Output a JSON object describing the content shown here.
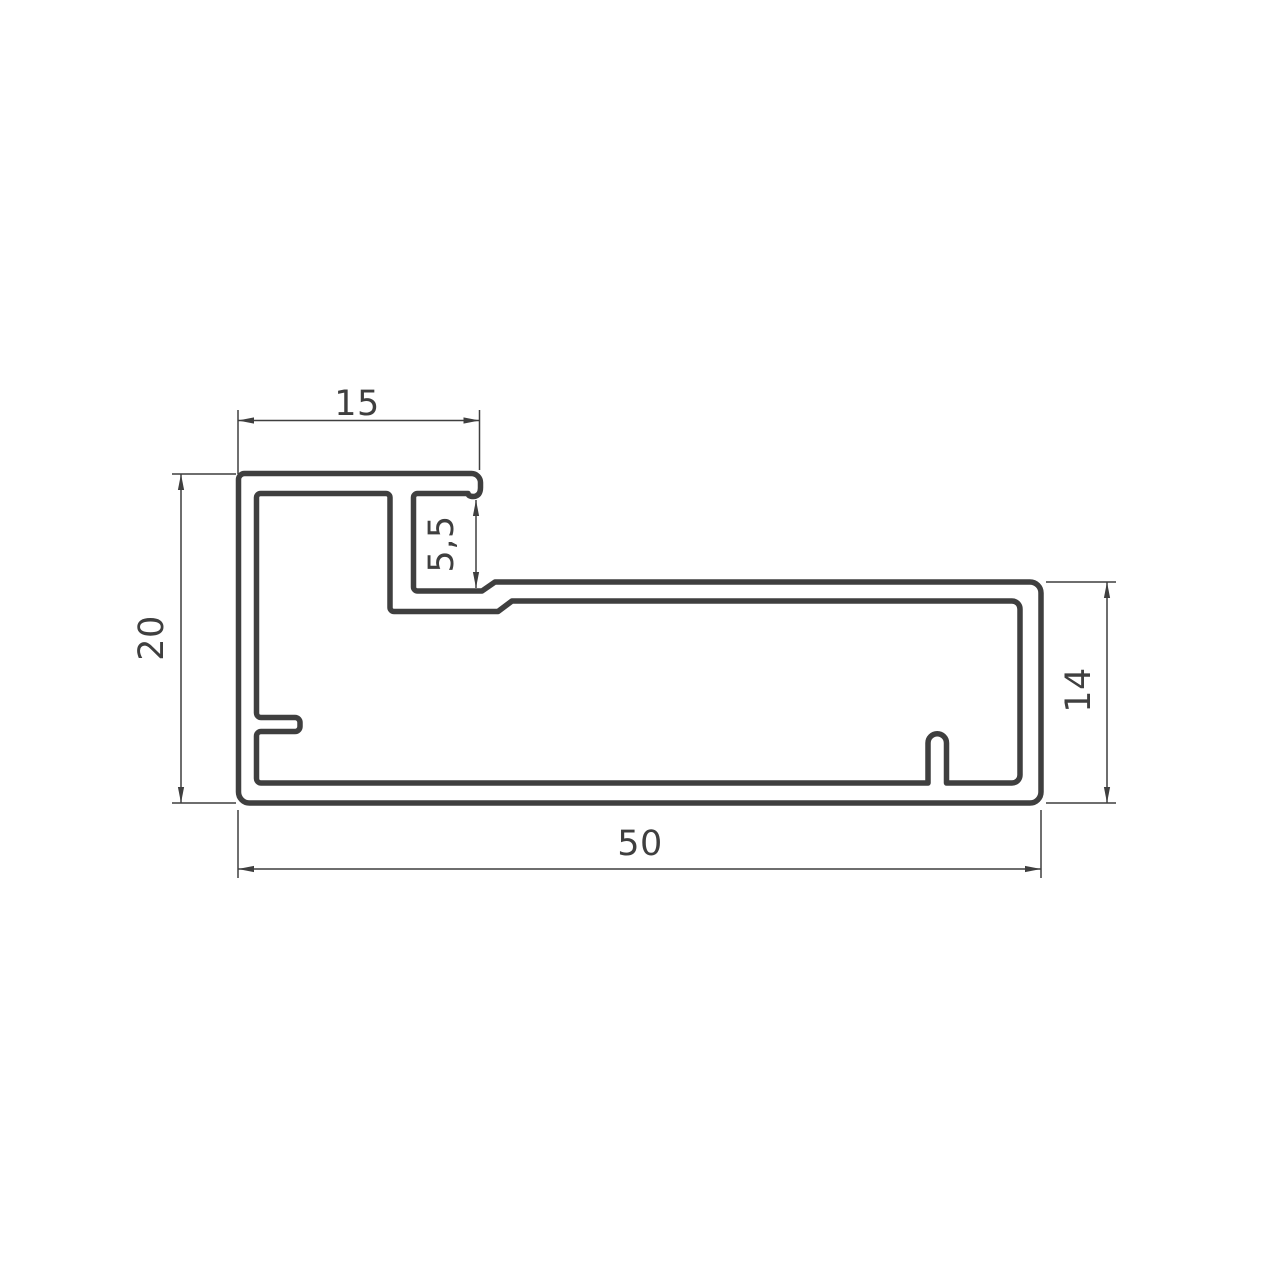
{
  "drawing": {
    "background_color": "#ffffff",
    "line_color": "#3f3f3f",
    "dimensions": {
      "flange_width": {
        "label": "15"
      },
      "slot_opening": {
        "label": "5,5"
      },
      "overall_height": {
        "label": "20"
      },
      "body_height": {
        "label": "14"
      },
      "overall_width": {
        "label": "50"
      }
    }
  }
}
